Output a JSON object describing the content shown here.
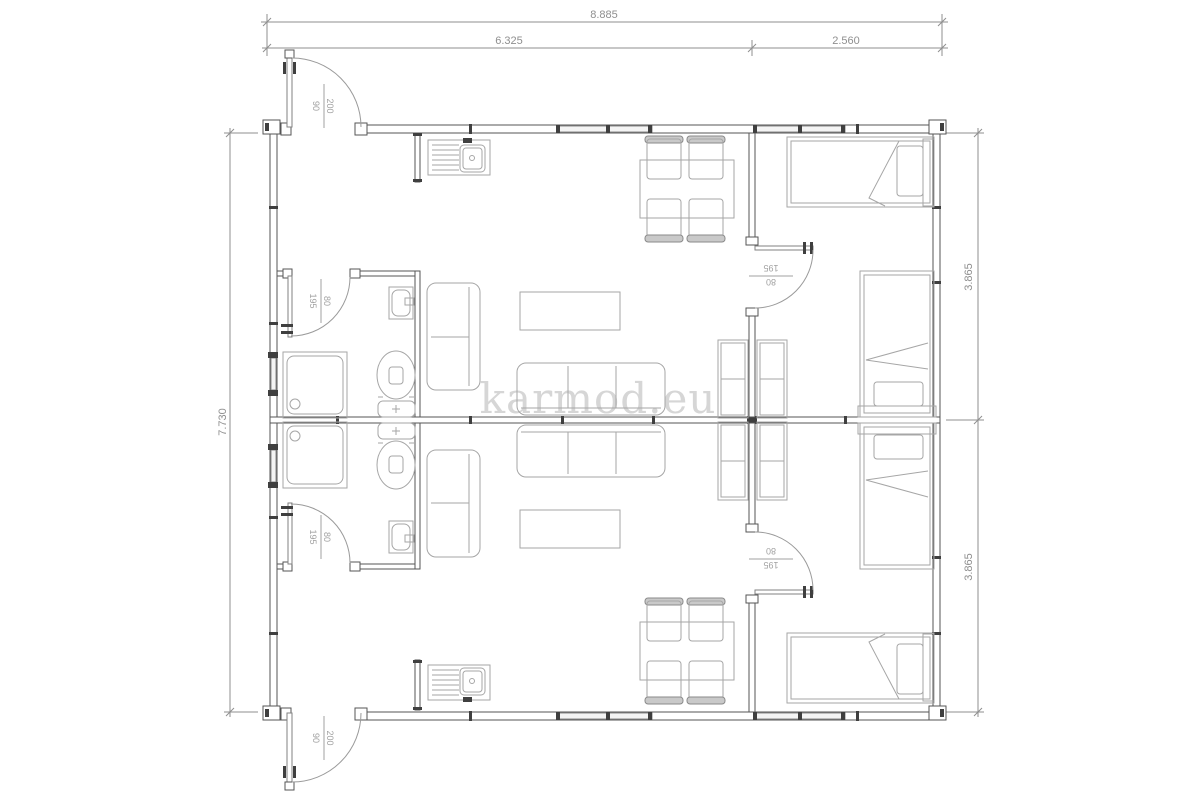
{
  "watermark": "karmod.eu",
  "dimensions": {
    "top_total": "8.885",
    "top_left": "6.325",
    "top_right": "2.560",
    "left_height": "7.730",
    "right_upper": "3.865",
    "right_lower": "3.865"
  },
  "door_annotations": {
    "entrance_top": {
      "num": "200",
      "den": "90"
    },
    "entrance_bottom": {
      "num": "200",
      "den": "90"
    },
    "bathroom_top": {
      "num": "80",
      "den": "195"
    },
    "bathroom_bottom": {
      "num": "80",
      "den": "195"
    },
    "bedroom_top": {
      "num": "80",
      "den": "195"
    },
    "bedroom_bottom": {
      "num": "195",
      "den": "80"
    }
  },
  "colors": {
    "wall": "#565656",
    "furniture": "#a6a6a6",
    "dimension": "#8f8f8f",
    "watermark": "#d6d6d6",
    "hatch": "#3f3f3f"
  }
}
